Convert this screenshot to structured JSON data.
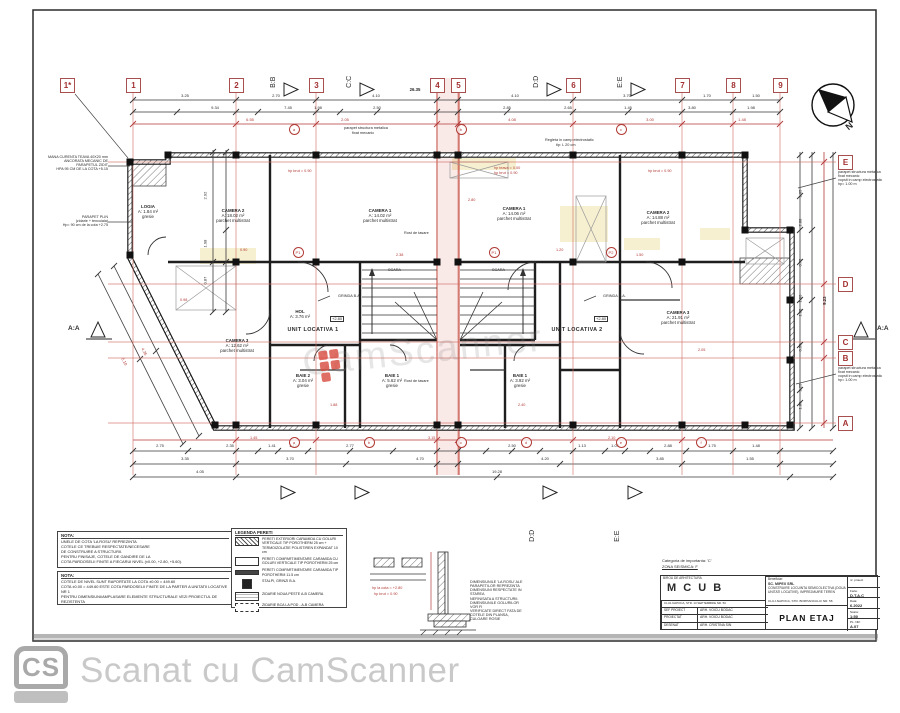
{
  "watermark": {
    "text": "CamScanner"
  },
  "cs_bar": {
    "logo": "CS",
    "text": "Scanat cu CamScanner"
  },
  "grid": {
    "top_axes": [
      {
        "label": "1*",
        "x": 67
      },
      {
        "label": "1",
        "x": 133
      },
      {
        "label": "2",
        "x": 236
      },
      {
        "label": "3",
        "x": 316
      },
      {
        "label": "4",
        "x": 437
      },
      {
        "label": "5",
        "x": 458
      },
      {
        "label": "6",
        "x": 573
      },
      {
        "label": "7",
        "x": 682
      },
      {
        "label": "8",
        "x": 733
      },
      {
        "label": "9",
        "x": 780
      }
    ],
    "right_axes": [
      {
        "label": "E",
        "y": 162
      },
      {
        "label": "D",
        "y": 284
      },
      {
        "label": "C",
        "y": 342
      },
      {
        "label": "B",
        "y": 358
      },
      {
        "label": "A",
        "y": 423
      }
    ],
    "section_markers_top": [
      {
        "label": "B:B",
        "x": 281
      },
      {
        "label": "C:C",
        "x": 357
      },
      {
        "label": "D:D",
        "x": 544
      },
      {
        "label": "E:E",
        "x": 628
      }
    ],
    "section_markers_bottom": [
      {
        "label": "B:B",
        "x": 278
      },
      {
        "label": "C:C",
        "x": 352
      },
      {
        "label": "D:D",
        "x": 540
      },
      {
        "label": "E:E",
        "x": 625
      }
    ],
    "section_left": "A:A",
    "section_right": "A:A",
    "north_label": "N"
  },
  "dims": {
    "top1": {
      "y": 94,
      "items": [
        [
          "3.25",
          185
        ],
        [
          "2.70",
          276
        ],
        [
          "4.10",
          376
        ],
        [
          "4.10",
          515
        ],
        [
          "3.70",
          627
        ],
        [
          "1.70",
          707
        ],
        [
          "1.50",
          756
        ]
      ]
    },
    "top2": {
      "y": 106,
      "items": [
        [
          "9.34",
          215
        ],
        [
          "7.45",
          288
        ],
        [
          "1.98",
          318
        ],
        [
          "2.50",
          377
        ],
        [
          "2.85",
          507
        ],
        [
          "2.65",
          568
        ],
        [
          "1.45",
          628
        ],
        [
          "3.80",
          692
        ],
        [
          "1.98",
          751
        ]
      ]
    },
    "top3": {
      "y": 118,
      "red": true,
      "items": [
        [
          "6.55",
          250
        ],
        [
          "2.05",
          345
        ],
        [
          "4.08",
          512
        ],
        [
          "3.00",
          650
        ],
        [
          "1.48",
          742
        ]
      ]
    },
    "overall_top": [
      "26.35",
      415,
      88
    ],
    "bottom1": {
      "y": 444,
      "items": [
        [
          "2.75",
          160
        ],
        [
          "2.35",
          230
        ],
        [
          "1.41",
          272
        ],
        [
          "1.12",
          293
        ],
        [
          "2.77",
          350
        ],
        [
          "2.50",
          512
        ],
        [
          "1.13",
          582
        ],
        [
          "1.07",
          615
        ],
        [
          "2.88",
          668
        ],
        [
          "1.75",
          712
        ],
        [
          "1.48",
          756
        ]
      ]
    },
    "bottom2": {
      "y": 457,
      "items": [
        [
          "3.35",
          185
        ],
        [
          "3.70",
          290
        ],
        [
          "4.70",
          420
        ],
        [
          "4.20",
          545
        ],
        [
          "3.85",
          660
        ],
        [
          "1.55",
          750
        ]
      ]
    },
    "bottom3": {
      "y": 470,
      "items": [
        [
          "4.05",
          200
        ],
        [
          "19.28",
          497
        ]
      ]
    },
    "left": {
      "x": 208,
      "items": [
        [
          "2.92",
          195
        ],
        [
          "1.98",
          243
        ],
        [
          "0.87",
          280
        ]
      ]
    },
    "right": {
      "x": 803,
      "items": [
        [
          "1.05",
          193
        ],
        [
          "2.88",
          222
        ],
        [
          "0.75",
          262
        ],
        [
          "1.90",
          298
        ],
        [
          "1.85",
          312
        ],
        [
          "0.50",
          347
        ],
        [
          "2.25",
          387
        ],
        [
          "1.80",
          405
        ]
      ]
    },
    "overall_right": [
      "9.23",
      828,
      300
    ],
    "diag": [
      [
        "4.35",
        140,
        345
      ],
      [
        "5.10",
        120,
        355
      ]
    ]
  },
  "rooms": [
    {
      "lines": [
        "LOGIA",
        "A: 1.84 m²",
        "gresie"
      ],
      "x": 148,
      "y": 205
    },
    {
      "lines": [
        "CAMERA 2",
        "A: 18.02 m²",
        "parchet multistrat"
      ],
      "x": 233,
      "y": 209
    },
    {
      "lines": [
        "CAMERA 1",
        "A: 14.02 m²",
        "parchet multistrat"
      ],
      "x": 380,
      "y": 209
    },
    {
      "lines": [
        "CAMERA 1",
        "A: 14.06 m²",
        "parchet multistrat"
      ],
      "x": 514,
      "y": 207
    },
    {
      "lines": [
        "CAMERA 2",
        "A: 14.88 m²",
        "parchet multistrat"
      ],
      "x": 658,
      "y": 211
    },
    {
      "lines": [
        "CAMERA 3",
        "A: 21.91 m²",
        "parchet multistrat"
      ],
      "x": 678,
      "y": 311
    },
    {
      "lines": [
        "CAMERA 3",
        "A: 12.62 m²",
        "parchet multistrat"
      ],
      "x": 237,
      "y": 339
    },
    {
      "lines": [
        "BAIE 2",
        "A: 3.04 m²",
        "gresie"
      ],
      "x": 303,
      "y": 374
    },
    {
      "lines": [
        "BAIE 1",
        "A: 5.62 m²",
        "gresie"
      ],
      "x": 392,
      "y": 374
    },
    {
      "lines": [
        "BAIE 1",
        "A: 3.92 m²",
        "gresie"
      ],
      "x": 520,
      "y": 374
    },
    {
      "lines": [
        "HOL",
        "A: 3.76 m²"
      ],
      "x": 300,
      "y": 310
    }
  ],
  "units": [
    {
      "t": "UNIT LOCATIVA 1",
      "x": 313,
      "y": 327
    },
    {
      "t": "UNIT LOCATIVA 2",
      "x": 577,
      "y": 327
    }
  ],
  "misc_black": [
    {
      "t": "Rost de tasare",
      "x": 404,
      "y": 231
    },
    {
      "t": "Rost de tasare",
      "x": 404,
      "y": 379
    },
    {
      "t": "GRINDA B.A.",
      "x": 338,
      "y": 294
    },
    {
      "t": "GRINDA B.A.",
      "x": 603,
      "y": 294
    },
    {
      "t": "SCARA",
      "x": 388,
      "y": 268
    },
    {
      "t": "SCARA",
      "x": 492,
      "y": 268
    },
    {
      "t": "parapet structura metalica",
      "x": 344,
      "y": 126
    },
    {
      "t": "fixat mecanic",
      "x": 352,
      "y": 131
    },
    {
      "t": "Regleta in camp electrostatic",
      "x": 545,
      "y": 138
    },
    {
      "t": "tip: L 20 cm",
      "x": 556,
      "y": 143
    }
  ],
  "boxed_cotes": [
    {
      "t": "+2.80",
      "x": 330,
      "y": 316
    },
    {
      "t": "+2.80",
      "x": 594,
      "y": 316
    }
  ],
  "red_marks": [
    {
      "t": "hp teava = 0.00",
      "x": 494,
      "y": 166
    },
    {
      "t": "hp brut = 0.90",
      "x": 494,
      "y": 171
    },
    {
      "t": "hp brut = 0.90",
      "x": 288,
      "y": 169
    },
    {
      "t": "hp brut = 0.90",
      "x": 648,
      "y": 169
    },
    {
      "t": "2.80",
      "x": 468,
      "y": 198
    },
    {
      "t": "1.20",
      "x": 556,
      "y": 248
    },
    {
      "t": "0.90",
      "x": 240,
      "y": 248
    },
    {
      "t": "2.38",
      "x": 396,
      "y": 253
    },
    {
      "t": "1.50",
      "x": 636,
      "y": 253
    },
    {
      "t": "0.98",
      "x": 180,
      "y": 298
    },
    {
      "t": "2.05",
      "x": 698,
      "y": 348
    },
    {
      "t": "1.88",
      "x": 330,
      "y": 403
    },
    {
      "t": "2.40",
      "x": 518,
      "y": 403
    },
    {
      "t": "3.15",
      "x": 428,
      "y": 436
    },
    {
      "t": "1.45",
      "x": 250,
      "y": 436
    },
    {
      "t": "2.10",
      "x": 608,
      "y": 436
    }
  ],
  "p_markers": [
    {
      "t": "P1",
      "x": 297,
      "y": 251
    },
    {
      "t": "P1",
      "x": 493,
      "y": 251
    },
    {
      "t": "P2",
      "x": 610,
      "y": 251
    }
  ],
  "circles_top": {
    "y": 128,
    "items": [
      [
        "a",
        293
      ],
      [
        "b",
        460
      ],
      [
        "c",
        620
      ]
    ]
  },
  "circles_bottom": {
    "y": 441,
    "items": [
      [
        "a",
        293
      ],
      [
        "b",
        368
      ],
      [
        "c",
        460
      ],
      [
        "d",
        525
      ],
      [
        "e",
        620
      ],
      [
        "f",
        700
      ]
    ]
  },
  "annotations": [
    {
      "lines": [
        "MANA CURENTA TEAVA 40X20 mm",
        "ANCORATA MECANIC DE",
        "PARAPETUL ZIDIT",
        "HPA 95 CM DE LA COTA +5.15"
      ],
      "x": 34,
      "y": 155,
      "w": 74,
      "align": "right"
    },
    {
      "lines": [
        "PARAPET PLIN",
        "(zidarie + tencuiala)",
        "Hp= 90 cm de la cota +2.75"
      ],
      "x": 38,
      "y": 215,
      "w": 70,
      "align": "right"
    },
    {
      "lines": [
        "parapet structura metalica",
        "fixat mecanic",
        "vopsit in camp electrostatic",
        "hp= 1.00 m"
      ],
      "x": 838,
      "y": 170,
      "w": 56,
      "align": "left"
    },
    {
      "lines": [
        "parapet structura metalica",
        "fixat mecanic",
        "vopsit in camp electrostatic",
        "hp= 1.00 m"
      ],
      "x": 838,
      "y": 366,
      "w": 56,
      "align": "left"
    }
  ],
  "notes": {
    "box1_title": "NOTA:",
    "box1_lines": [
      "UNELE DE COTA 'LA ROSU' REPREZINTA",
      "COTELE CE TREBUIE RESPECTATE/NECESARE",
      "DE CONSTRUIRE A STRUCTURII.",
      "PENTRU FINISAJE, COTELE DE GANDIRE DE LA",
      "COTA PARDOSELII FINITE A FIECARUI NIVEL (±0.00, +2.80, +5.60)."
    ],
    "box2_title": "NOTA:",
    "box2_lines": [
      "COTELE DE NIVEL SUNT RAPORTATE LA COTA ±0.00 = 449.60",
      "COTA ±0.00 = 449.60 ESTE COTA PARDOSELII FINITE DE LA PARTER A UNITATII LOCATIVE NR 1",
      "PENTRU DIMENSIUNI/AMPLASARE ELEMENTE STRUCTURALE VEZI PROIECTUL DE REZISTENTA"
    ]
  },
  "legend": {
    "title": "LEGENDA PERETI",
    "items": [
      {
        "type": "ext",
        "text": "PERETI EXTERIORI CARAMIDA CU GOLURI VERTICALE TIP POROTHERM 25 cm + TERMOIZOLATIE POLISTIREN EXPANDAT 10 cm"
      },
      {
        "type": "int25",
        "text": "PERETI COMPARTIMENTARE CARAMIDA CU GOLURI VERTICALE TIP POROTHERM 25 cm"
      },
      {
        "type": "int11",
        "text": "PERETI COMPARTIMENTARE CARAMIDA TIP POROTHERM 11.5 cm"
      },
      {
        "type": "stalp",
        "text": "STALPI, GRINZI B.A."
      },
      {
        "type": "zid1",
        "text": "ZIDARIE NOUA PESTE A-B CAMERA"
      },
      {
        "type": "zid2",
        "text": "ZIDARIE BCA LA POD - A-B CAMERA"
      }
    ]
  },
  "detail": {
    "red1": "hp la cota = +2.80",
    "red2": "hp brut = 0.90",
    "note_lines": [
      "DIMENSIUNILE 'LA ROSU' ALE",
      "PARAPETILOR REPREZINTA",
      "DIMENSIUNI RESPECTATE IN STAREA",
      "NEFINISATA A STRUCTURII.",
      "DIMENSIUNILE GOLURILOR VOR FI",
      "VERIFICATE DIRECT FATA DE",
      "COTELE DIN PLANSA, CULOARE ROSIE"
    ]
  },
  "title_block": {
    "above1": "Categoria de importanta: 'C'",
    "above2": "ZONA SEISMICA: F",
    "office_small": "BIROU DE ARHITECTURA",
    "office_big": "M C U B",
    "office_addr": "CLUJ-NAPOCA, STR. 13 SEPTEMBRIE NR. 50",
    "rows": [
      {
        "role": "SEF PROIECT",
        "name": "ARH. VOICU BODAC"
      },
      {
        "role": "PROIECTAT",
        "name": "ARH. VOICU BODAC"
      },
      {
        "role": "DESENAT",
        "name": "ARH. CRISTINA SIN"
      }
    ],
    "beneficiar_label": "Beneficiar:",
    "beneficiar": "SC. MIPEX SRL",
    "project": "CONSTRUIRE LOCUINTA SEMICOLECTIVA (DOUA UNITATI LOCATIVE), IMPREJMUIRE TEREN",
    "addr": "CLUJ-NAPOCA, STR. BORHANCULUI NR. 58",
    "sheet_title": "PLAN ETAJ",
    "right_cells": [
      {
        "l": "nr. proiect",
        "v": ""
      },
      {
        "l": "Faza:",
        "v": "D.T.A.C"
      },
      {
        "l": "Data:",
        "v": "6.2022"
      },
      {
        "l": "Scara:",
        "v": "1:50"
      },
      {
        "l": "PL. NR:",
        "v": "A.07"
      }
    ]
  }
}
